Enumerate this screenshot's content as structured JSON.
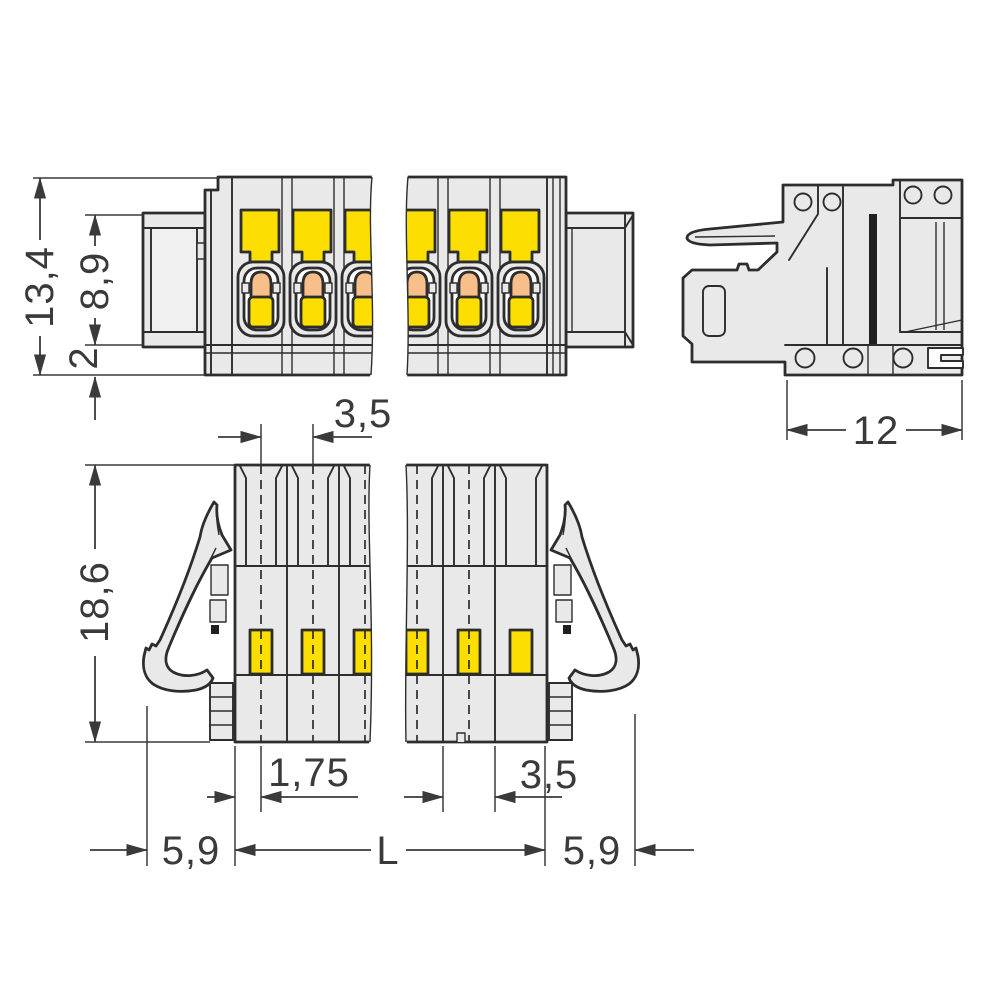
{
  "title": "Terminal block connector dimensional drawing",
  "units": "mm",
  "views": {
    "front": {
      "name": "front-view",
      "dims": {
        "total_height": "13,4",
        "flange_height": "8,9",
        "base_height": "2"
      }
    },
    "side": {
      "name": "side-view",
      "dims": {
        "depth": "12"
      }
    },
    "bottom": {
      "name": "bottom-view",
      "dims": {
        "pitch_top": "3,5",
        "overall_depth": "18,6",
        "half_pitch": "1,75",
        "pitch_bottom": "3,5",
        "left_margin": "5,9",
        "length": "L",
        "right_margin": "5,9"
      }
    }
  },
  "colors": {
    "body_gray": "#e9e9e9",
    "accent_yellow": "#fcdf00",
    "accent_orange": "#f7bf8a",
    "outline": "#2d2d2d",
    "dimension": "#3a3a3a",
    "background": "#ffffff"
  }
}
